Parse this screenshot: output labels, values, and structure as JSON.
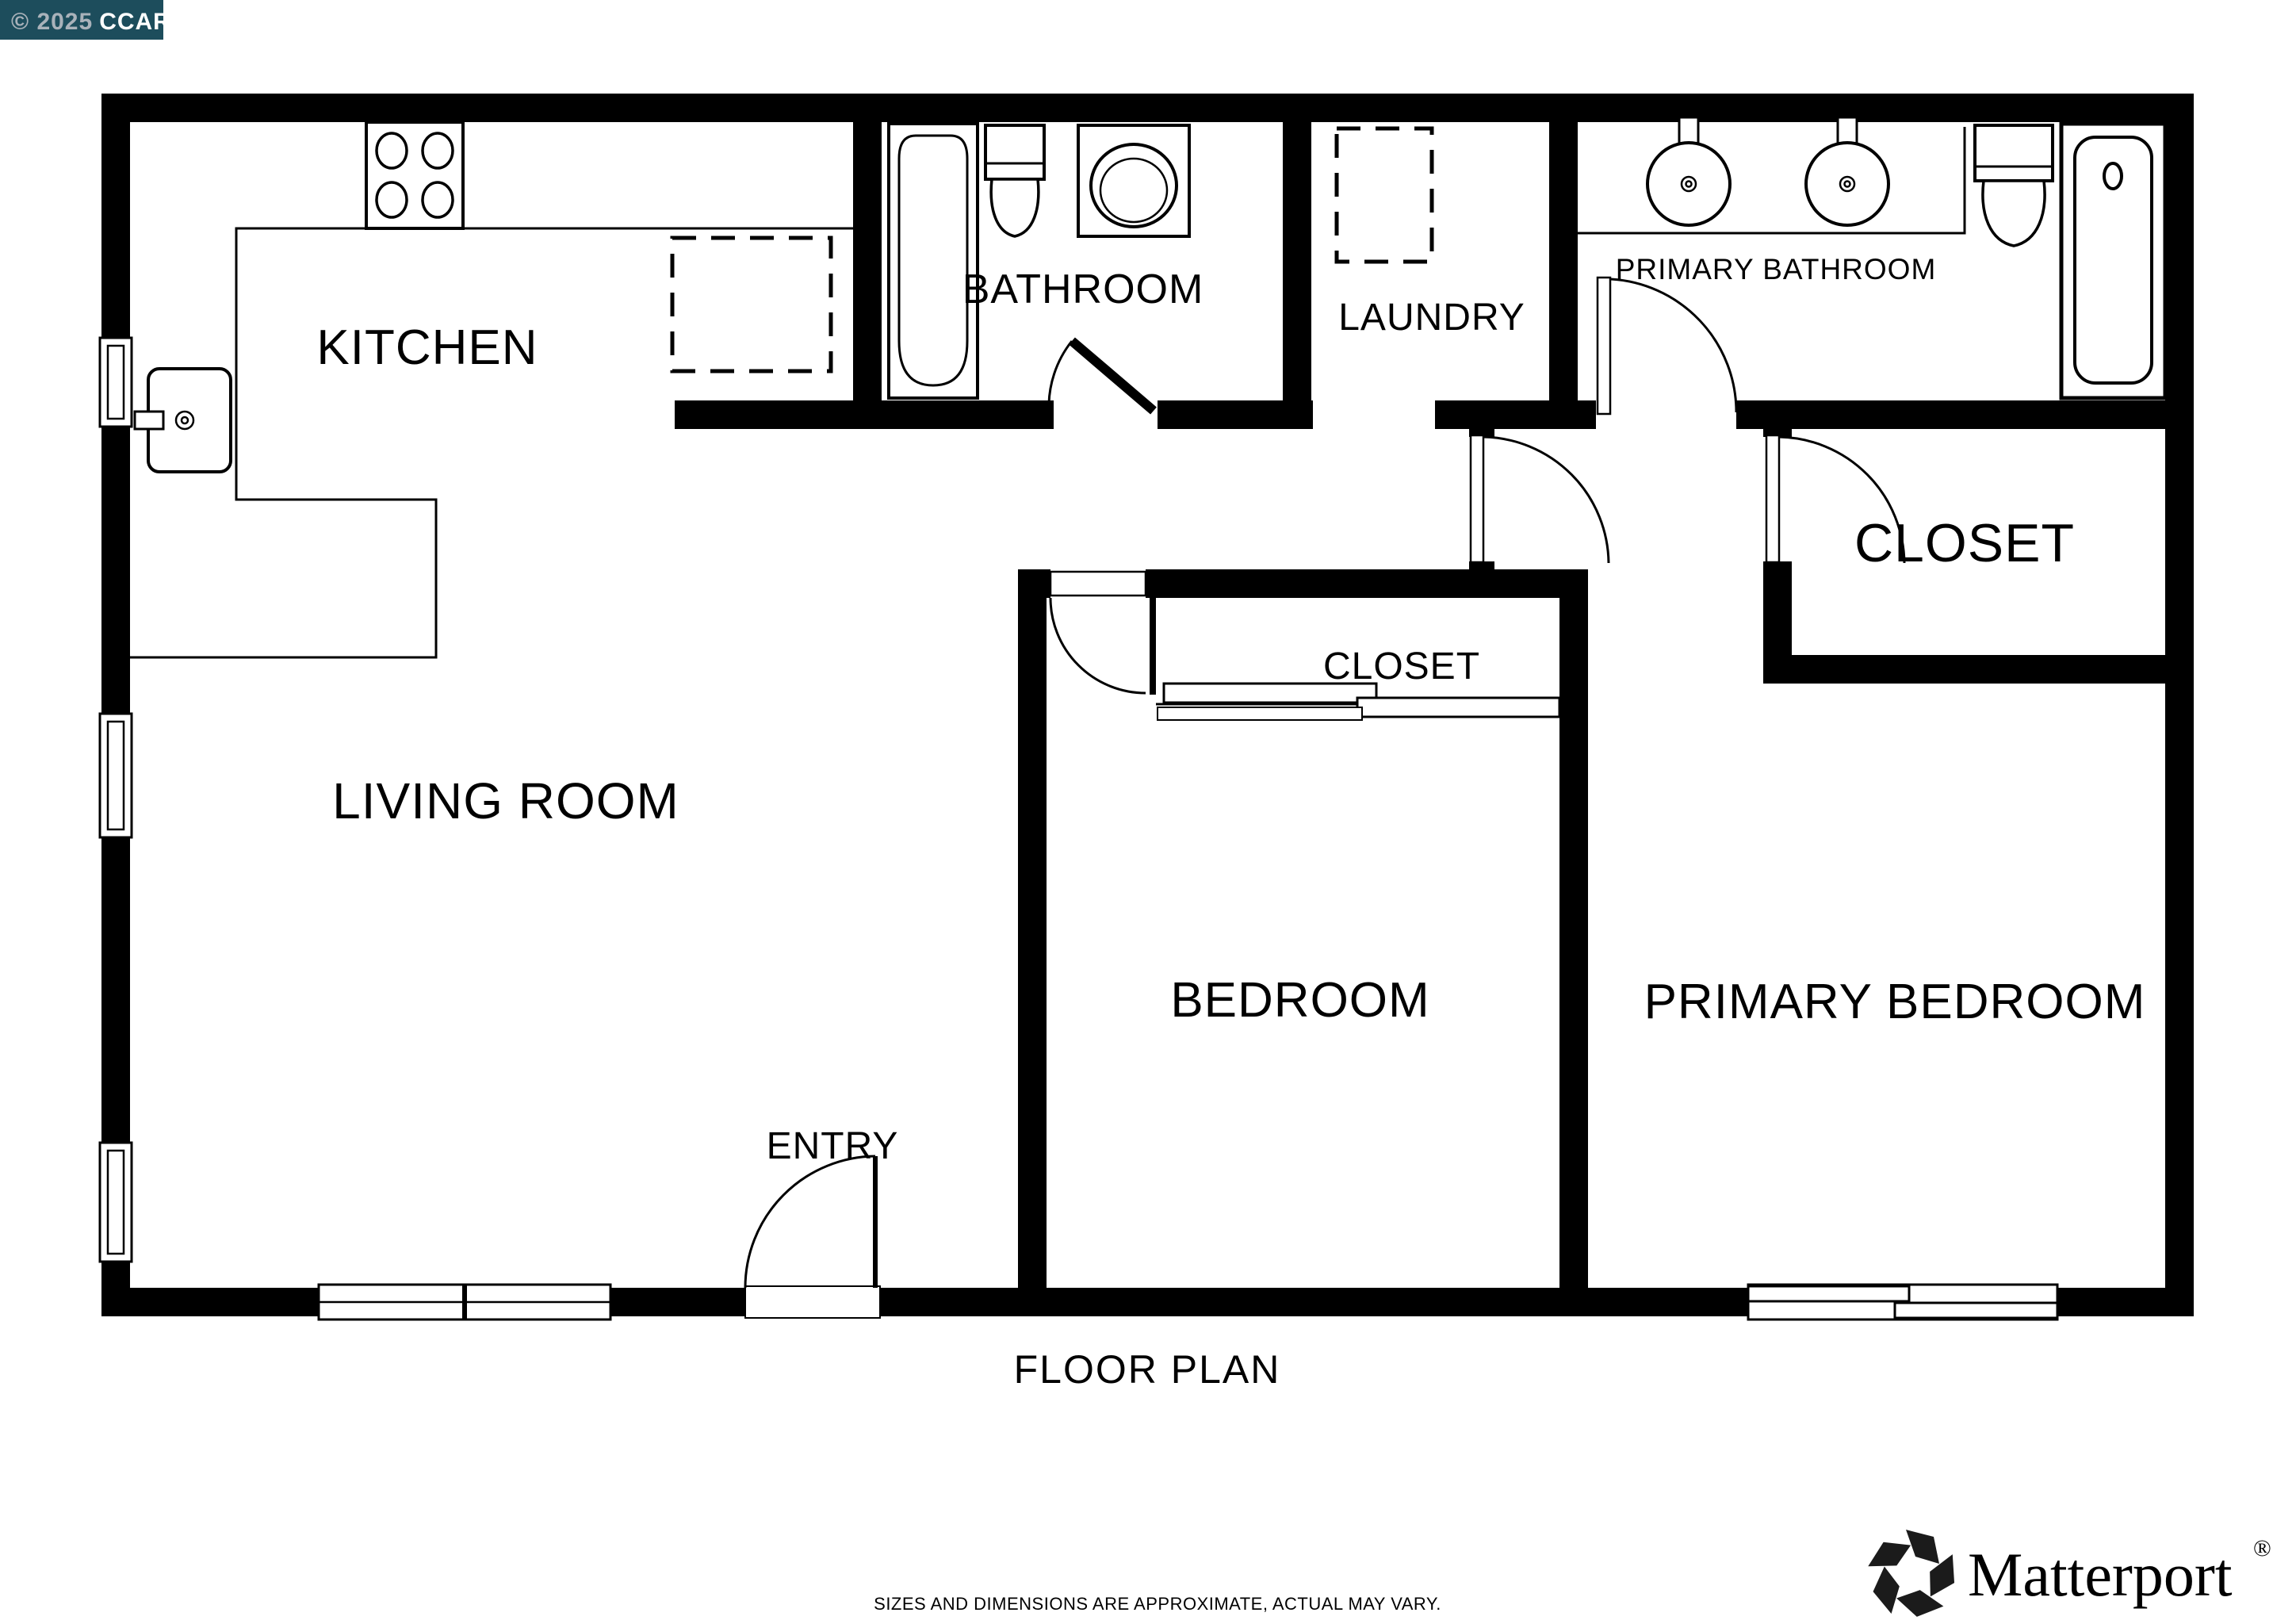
{
  "badge": {
    "copyright": "© 2025",
    "org": "CCAR",
    "bg_color": "#1d4d5c",
    "copyright_color": "#a9b2ba",
    "org_color": "#ffffff"
  },
  "rooms": {
    "kitchen": "KITCHEN",
    "bathroom": "BATHROOM",
    "laundry": "LAUNDRY",
    "primary_bathroom": "PRIMARY BATHROOM",
    "closet_primary": "CLOSET",
    "closet_bedroom": "CLOSET",
    "living_room": "LIVING ROOM",
    "entry": "ENTRY",
    "bedroom": "BEDROOM",
    "primary_bedroom": "PRIMARY BEDROOM"
  },
  "fixtures": {
    "stove": "4-burner cooktop",
    "kitchen_sink": "kitchen sink with faucet",
    "kitchen_appliance": "dashed appliance (dishwasher)",
    "bathtub": "bathtub",
    "bathroom_toilet": "toilet",
    "bathroom_sink": "vanity sink",
    "laundry_appliance": "dashed appliance (washer/dryer)",
    "primary_sink_left": "round sink",
    "primary_sink_right": "round sink",
    "primary_toilet": "toilet",
    "shower": "shower stall",
    "closet_sliding_doors": "bypass sliding doors"
  },
  "footer": {
    "title": "FLOOR PLAN",
    "disclaimer": "SIZES AND DIMENSIONS ARE APPROXIMATE, ACTUAL MAY VARY.",
    "disclaimer_color": "#7f7f7f"
  },
  "branding": {
    "name": "Matterport",
    "registered_mark": "®",
    "color": "#1b1b1b"
  },
  "colors": {
    "wall": "#000000",
    "floor": "#ffffff"
  }
}
